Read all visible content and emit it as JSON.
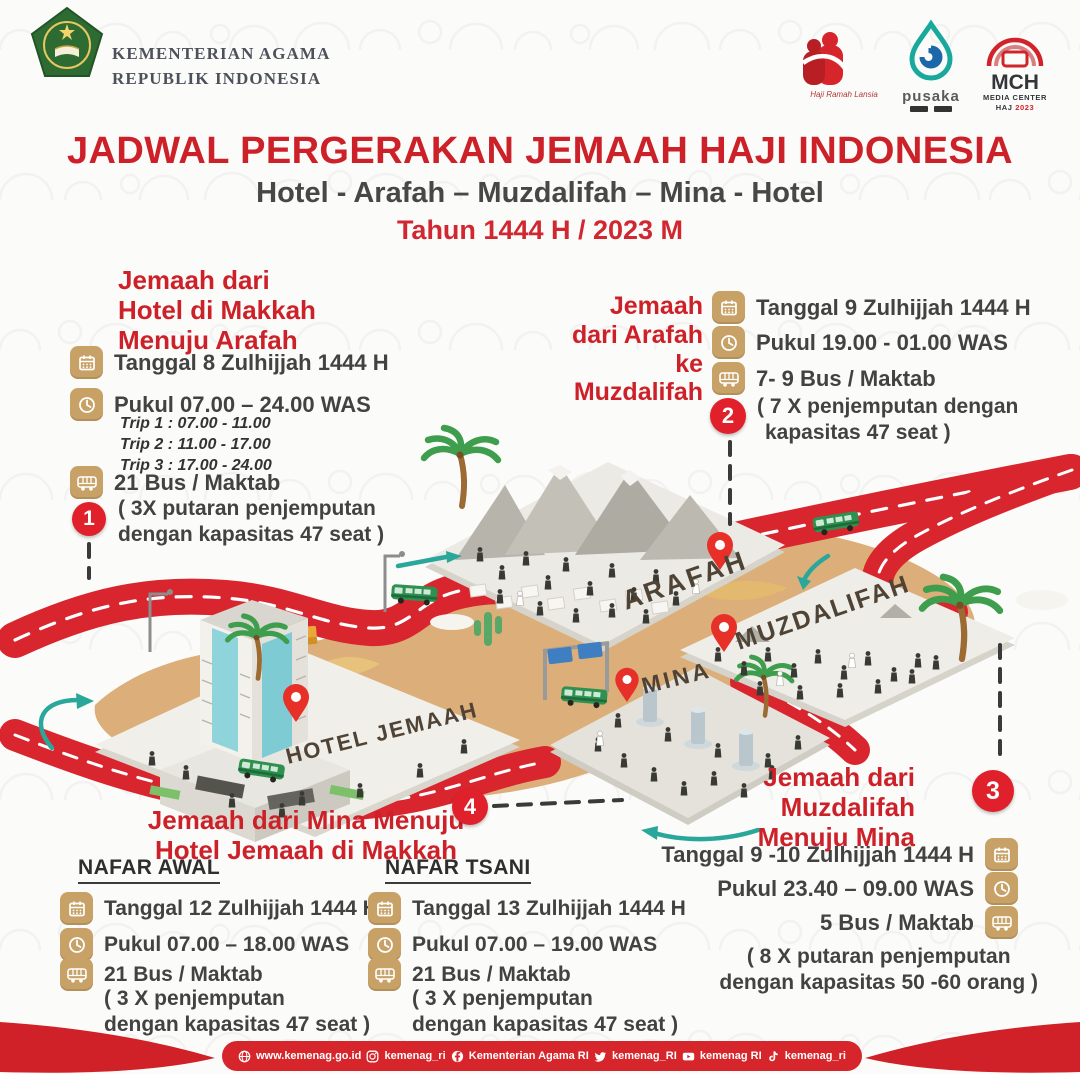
{
  "header": {
    "ministry": [
      "KEMENTERIAN AGAMA",
      "REPUBLIK INDONESIA"
    ],
    "logos": {
      "lansia_caption": "Haji Ramah Lansia",
      "pusaka_name": "pusaka",
      "mch_name": "MCH",
      "mch_tagline": "MEDIA CENTER",
      "mch_haj": "HAJ",
      "mch_year": "2023"
    }
  },
  "title": {
    "main": "JADWAL PERGERAKAN JEMAAH HAJI INDONESIA",
    "route": "Hotel - Arafah – Muzdalifah – Mina - Hotel",
    "year": "Tahun 1444 H / 2023 M"
  },
  "sections": {
    "s1": {
      "badge": "1",
      "title": [
        "Jemaah dari",
        "Hotel di Makkah",
        "Menuju Arafah"
      ],
      "date": "Tanggal 8 Zulhijjah 1444 H",
      "time": "Pukul 07.00 – 24.00 WAS",
      "trips": [
        "Trip 1 : 07.00 - 11.00",
        "Trip 2 : 11.00 - 17.00",
        "Trip 3 : 17.00 - 24.00"
      ],
      "bus": "21 Bus / Maktab",
      "note": [
        "( 3X putaran penjemputan",
        "dengan kapasitas 47 seat )"
      ]
    },
    "s2": {
      "badge": "2",
      "title": [
        "Jemaah",
        "dari Arafah",
        "ke Muzdalifah"
      ],
      "date": "Tanggal 9 Zulhijjah 1444 H",
      "time": "Pukul 19.00 - 01.00 WAS",
      "bus": "7- 9 Bus / Maktab",
      "note": [
        "( 7 X penjemputan dengan",
        "kapasitas 47 seat )"
      ]
    },
    "s3": {
      "badge": "3",
      "title": [
        "Jemaah dari",
        "Muzdalifah",
        "Menuju Mina"
      ],
      "date": "Tanggal 9 -10 Zulhijjah 1444 H",
      "time": "Pukul 23.40 – 09.00 WAS",
      "bus": "5 Bus / Maktab",
      "note": [
        "( 8 X putaran penjemputan",
        "dengan kapasitas 50 -60 orang )"
      ]
    },
    "s4": {
      "badge": "4",
      "title": [
        "Jemaah dari Mina Menuju",
        "Hotel Jemaah di Makkah"
      ],
      "nafar_awal": {
        "header": "NAFAR AWAL",
        "date": "Tanggal 12 Zulhijjah 1444 H",
        "time": "Pukul 07.00 – 18.00 WAS",
        "bus": "21 Bus / Maktab",
        "note": [
          "( 3 X penjemputan",
          "dengan kapasitas 47 seat )"
        ]
      },
      "nafar_tsani": {
        "header": "NAFAR TSANI",
        "date": "Tanggal 13 Zulhijjah 1444 H",
        "time": "Pukul 07.00 – 19.00 WAS",
        "bus": "21 Bus / Maktab",
        "note": [
          "( 3 X penjemputan",
          "dengan kapasitas 47 seat )"
        ]
      }
    }
  },
  "map": {
    "labels": {
      "arafah": "ARAFAH",
      "muzdalifah": "MUZDALIFAH",
      "mina": "MINA",
      "hotel": "HOTEL JEMAAH"
    }
  },
  "footer": {
    "items": [
      {
        "icon": "globe",
        "text": "www.kemenag.go.id"
      },
      {
        "icon": "instagram",
        "text": "kemenag_ri"
      },
      {
        "icon": "facebook",
        "text": "Kementerian Agama RI"
      },
      {
        "icon": "twitter",
        "text": "kemenag_RI"
      },
      {
        "icon": "youtube",
        "text": "kemenag RI"
      },
      {
        "icon": "tiktok",
        "text": "kemenag_ri"
      }
    ]
  },
  "colors": {
    "accent_red": "#cd2129",
    "badge_red": "#e0202a",
    "icon_tan": "#c7a166",
    "sand": "#dcae79",
    "road_red": "#d8252e",
    "teal": "#2aa79b",
    "bus_green": "#2e9150"
  }
}
